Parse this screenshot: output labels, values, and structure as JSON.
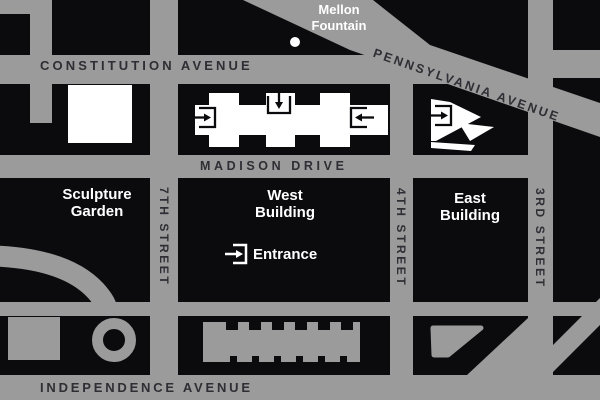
{
  "theme": {
    "street-gray": "#9b9b9b",
    "block-black": "#0b0b0e",
    "street-label": "#2e2e34",
    "label-white": "#ffffff",
    "footprint-white": "#ffffff"
  },
  "streets": {
    "constitution_avenue": "CONSTITUTION AVENUE",
    "pennsylvania_avenue": "PENNSYLVANIA AVENUE",
    "madison_drive": "MADISON DRIVE",
    "independence_avenue": "INDEPENDENCE AVENUE",
    "seventh_street": "7TH STREET",
    "fourth_street": "4TH STREET",
    "third_street": "3RD STREET"
  },
  "landmarks": {
    "mellon_fountain": {
      "line1": "Mellon",
      "line2": "Fountain"
    },
    "sculpture_garden": {
      "line1": "Sculpture",
      "line2": "Garden"
    },
    "west_building": {
      "line1": "West",
      "line2": "Building"
    },
    "east_building": {
      "line1": "East",
      "line2": "Building"
    },
    "entrance": "Entrance"
  },
  "icons": {
    "west_left": "entrance-arrow-right-into-bracket",
    "west_top": "entrance-arrow-down-into-bracket",
    "west_right": "entrance-arrow-left-into-bracket",
    "east": "entrance-arrow-right-into-bracket",
    "legend": "entrance-arrow-right-into-bracket",
    "fountain": "fountain-dot"
  }
}
